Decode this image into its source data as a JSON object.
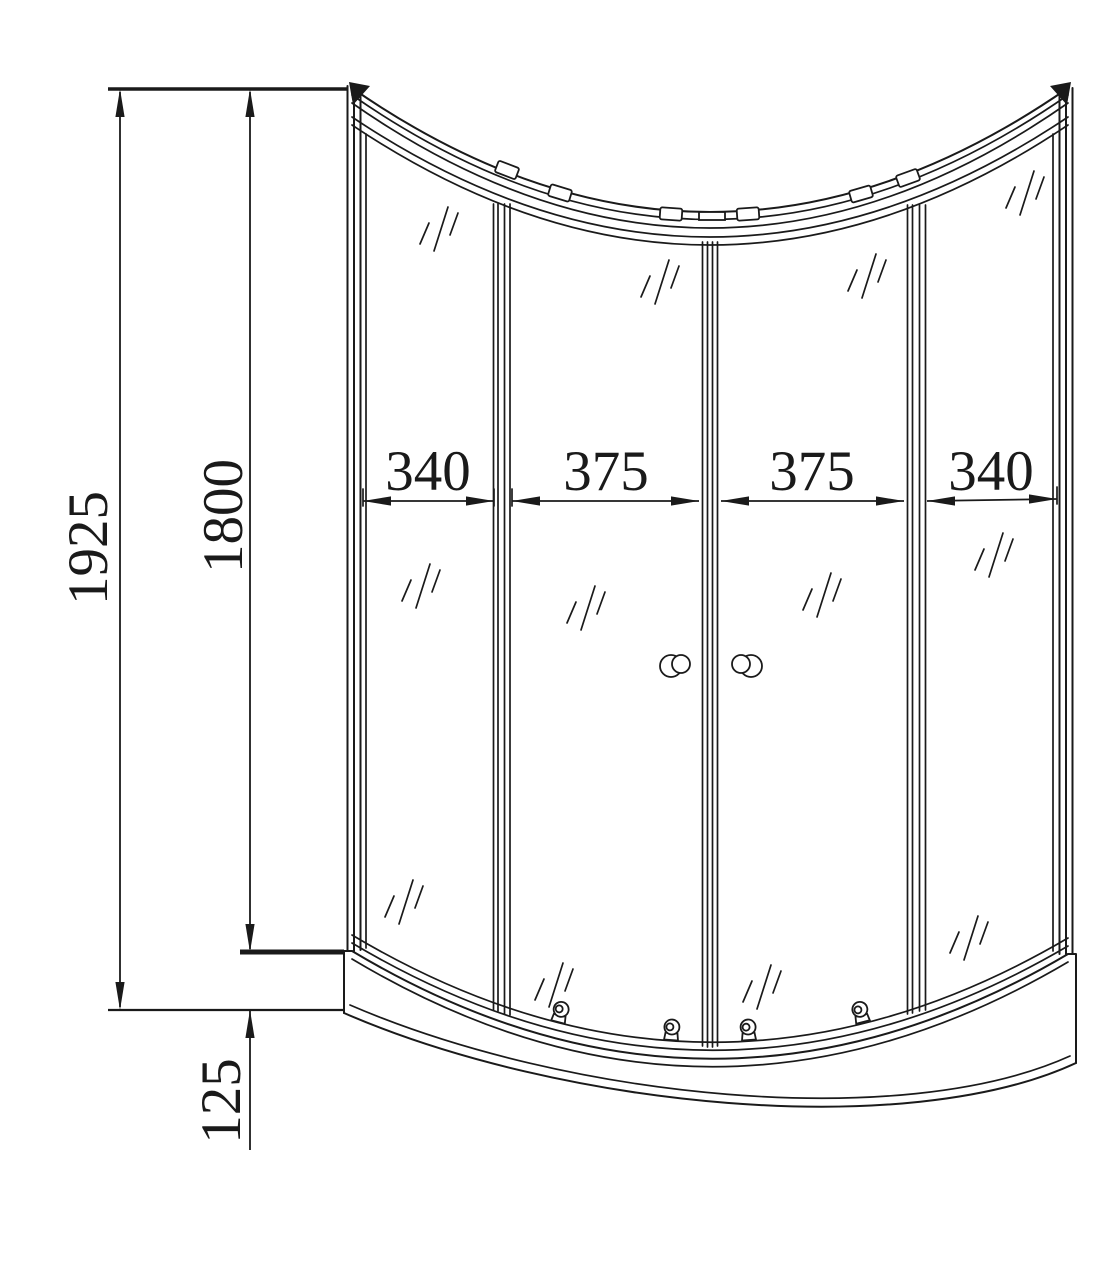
{
  "colors": {
    "line": "#1a1a1a",
    "background": "#ffffff"
  },
  "dimensions": {
    "overall_height": "1925",
    "enclosure_height": "1800",
    "tray_height": "125",
    "panel_widths": [
      "340",
      "375",
      "375",
      "340"
    ]
  }
}
